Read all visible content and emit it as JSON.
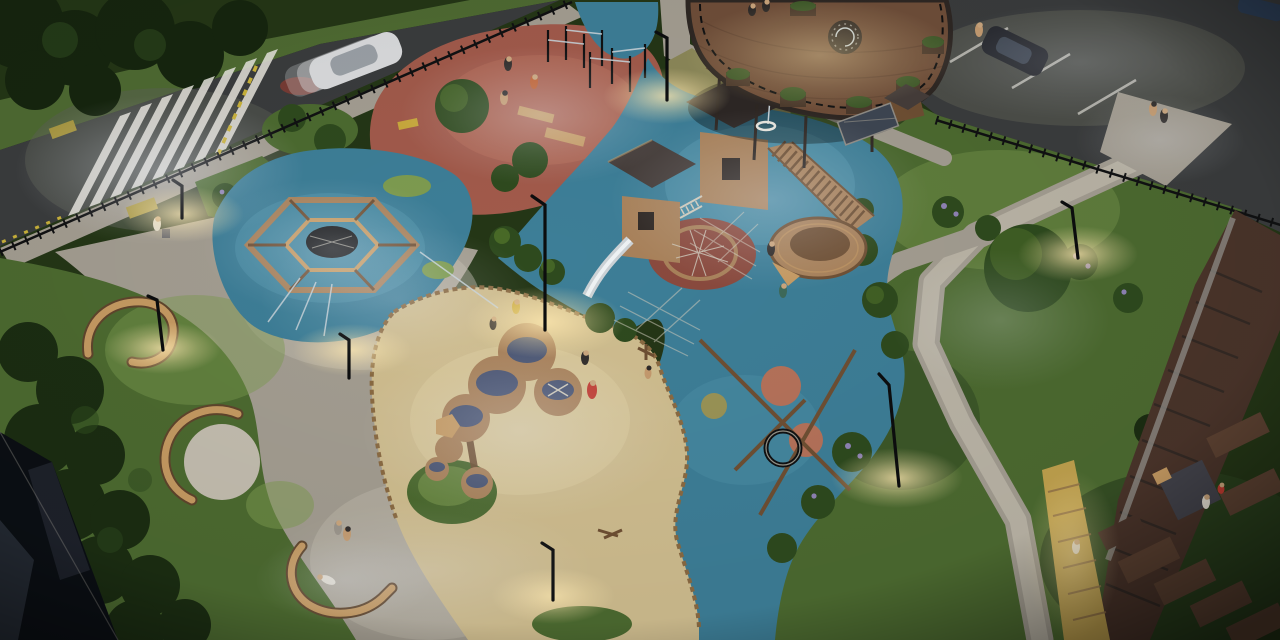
{
  "scene": {
    "title": "Night aerial 3D rendering of a residential courtyard playground",
    "areas": {
      "road": "asphalt street with zebra crosswalk and moving white car",
      "parking": "parking lot with marked stalls and two parked cars",
      "calisthenics": "red rubber workout zone with pull-up bars and benches",
      "hexagon_climber": "blue rubber zone with hexagonal wooden rope climber",
      "main_playground": "blue rubber zone with wooden play towers, slide, rope nets and ship structure",
      "sand_area": "sand play zone with wooden water-play tables",
      "swing": "rope nest swing on blue rubber with colored circles",
      "deck": "elevated round wooden terrace with planters and spiral stair",
      "benches": "serpentine wooden benches on lawns",
      "loungers": "wooden deck loungers near lit boardwalk",
      "greenery": "lawns, hedges, trees and lavender bushes",
      "lighting": "bent black street lamps with warm light pools"
    }
  },
  "colors": {
    "base_lawn": "#243616",
    "asphalt": "#3a3c3d",
    "asphalt_lit": "#5e6056",
    "road_verge": "#4e6a32",
    "paver": "#a39d91",
    "paver_lit": "#c3bdaf",
    "paver_shadow": "#7e7a70",
    "olive_ground": "#8b8758",
    "lawn": "#4c6a30",
    "lawn_lit": "#7d9b50",
    "lawn_dark": "#2c431f",
    "hedge": "#1b2d12",
    "tree_dark": "#16250f",
    "tree": "#2e4a1e",
    "tree_lit": "#4f7029",
    "rubber_blue": "#3d7e97",
    "rubber_blue_lit": "#5496ad",
    "rubber_blue_dark": "#2d6780",
    "rubber_red": "#a15a4b",
    "rubber_red_lit": "#b56c57",
    "rubber_red_dark": "#7e463c",
    "sand": "#cfbd8f",
    "sand_lit": "#ddcea0",
    "sand_dark": "#ab9a70",
    "wood": "#a8815a",
    "wood_dark": "#6e4f33",
    "wood_lit": "#c59a62",
    "bench_shadow": "#5f452c",
    "log_edge": "#8a6a42",
    "roof": "#453d3a",
    "deck_wood": "#6f4e39",
    "deck_rim": "#2e2723",
    "deck_plank": "#5d4130",
    "fence": "#101112",
    "lamp": "#0c0d0e",
    "white_paint": "#e9e7df",
    "yellow_paint": "#c9b23a",
    "tactile_yellow": "#a8973f",
    "water_top": "#4a5573",
    "net_rope": "#cfcabb",
    "metal_slide": "#ccd2d6",
    "metal_slide_lit": "#eef2f4",
    "circle_orange": "#b5725a",
    "circle_olive": "#9a9356",
    "circle_red": "#8a4a3e",
    "car_white": "#d9dadc",
    "car_roof": "#9aa0a6",
    "car_dark": "#24262c",
    "car_blue": "#2d3f58",
    "tail_red": "#c0392b",
    "boardwalk_lit": "#c0a14e",
    "lounger": "#4a342a",
    "lounger_lit": "#5d4232",
    "platform": "#43434b",
    "concrete": "#8f8c86",
    "lavender": "#8f83b5",
    "planter_green": "#3f5a2a",
    "planter_box": "#4c3a2c",
    "glow_warm": "#ffe9b0",
    "glow_cool": "#eef3ff",
    "building_dark": "#0b0f14",
    "building_grey": "#3e4652",
    "metal_pole": "#c7d2d8",
    "skin": "#c49a6e",
    "head": "#caa57c",
    "shirt_white": "#e3ded2",
    "shirt_red": "#c03a30",
    "shirt_orange": "#c06030",
    "shirt_dark": "#2e2a28",
    "shirt_teal": "#3e6a5a",
    "shirt_grey": "#9a948a",
    "shirt_yellow": "#c8a83c",
    "stroller": "#6a6a70",
    "shadow": "#000000"
  }
}
